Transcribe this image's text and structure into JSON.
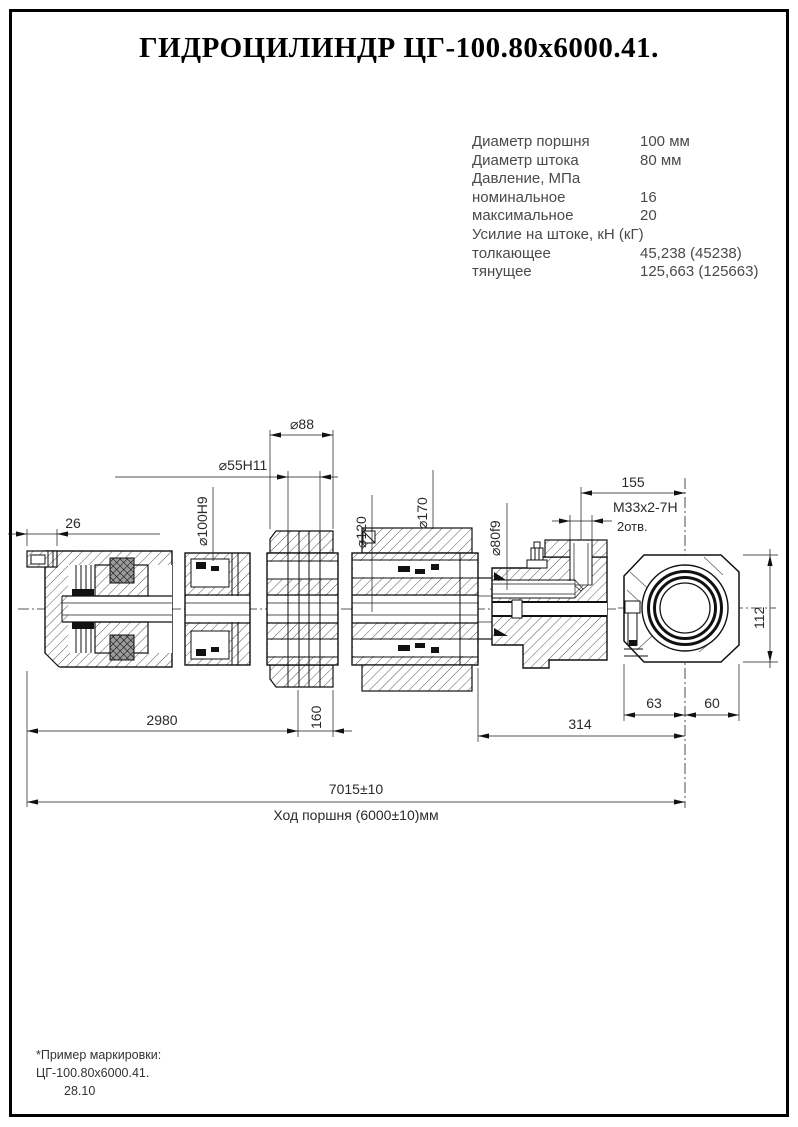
{
  "title": "ГИДРОЦИЛИНДР ЦГ-100.80х6000.41.",
  "specs": {
    "rows": [
      {
        "label": "Диаметр поршня",
        "value": "100 мм"
      },
      {
        "label": "Диаметр штока",
        "value": "80 мм"
      },
      {
        "label": "Давление, МПа",
        "value": ""
      },
      {
        "label": "номинальное",
        "value": "16"
      },
      {
        "label": "максимальное",
        "value": "20"
      },
      {
        "label": "Усилие на штоке, кН (кГ)",
        "value": ""
      },
      {
        "label": "толкающее",
        "value": "45,238 (45238)"
      },
      {
        "label": "тянущее",
        "value": "125,663 (125663)"
      }
    ]
  },
  "dims": {
    "plug": "26",
    "d100": "⌀100H9",
    "d55": "⌀55H11",
    "d88": "⌀88",
    "d120": "⌀120",
    "d170": "⌀170",
    "d80": "⌀80f9",
    "l155": "155",
    "thread": "М33х2-7Н",
    "holes": "2отв.",
    "h112": "112",
    "l2980": "2980",
    "l160": "160",
    "l314": "314",
    "l63": "63",
    "l60": "60",
    "total": "7015±10",
    "stroke": "Ход поршня (6000±10)мм"
  },
  "footer": {
    "note": "*Пример маркировки:",
    "marking": "ЦГ-100.80х6000.41.",
    "code": "28.10"
  }
}
